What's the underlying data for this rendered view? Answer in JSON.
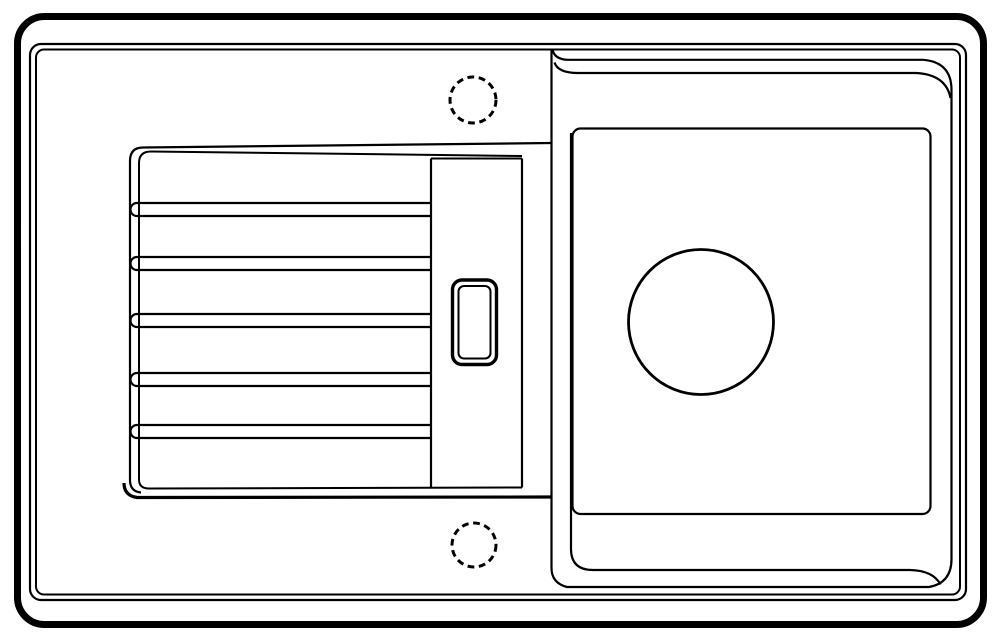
{
  "canvas": {
    "width": 1000,
    "height": 634,
    "background_color": "#ffffff",
    "line_color": "#000000"
  },
  "diagram": {
    "subject": "kitchen-sink-top-view-technical-line-drawing",
    "sections": {
      "left": "ribbed drainboard with pop-up control and two dashed faucet knockout holes",
      "right": "square bowl with round drain opening"
    },
    "default_stroke_width": 2.2,
    "shapes": [
      {
        "name": "sink-outer-edge",
        "kind": "rect",
        "x": 17.5,
        "y": 16.5,
        "width": 966,
        "height": 608,
        "rx": 27,
        "stroke_width": 7
      },
      {
        "name": "sink-rim-outer-line",
        "kind": "rect",
        "x": 30,
        "y": 44,
        "width": 936,
        "height": 556,
        "rx": 11,
        "stroke_width": 2.2
      },
      {
        "name": "sink-rim-inner-line",
        "kind": "rect",
        "x": 36,
        "y": 49.5,
        "width": 924,
        "height": 545,
        "rx": 8,
        "stroke_width": 2
      },
      {
        "name": "drainboard-outer-contour",
        "kind": "path",
        "d": "M 143 147.5 Q 130 147.5 130 161 L 130 480 Q 130 491.5 141 492.5",
        "stroke_width": 2.2
      },
      {
        "name": "drainboard-inner-contour",
        "kind": "path",
        "d": "M 151 151.5 Q 139 151.5 139 163 L 139 479.5 Q 139 488 148 488.5",
        "stroke_width": 2
      },
      {
        "name": "drainboard-top-edge",
        "kind": "path",
        "d": "M 143 147.5 L 551.5 143",
        "stroke_width": 2.2
      },
      {
        "name": "drainboard-top-inner-edge",
        "kind": "path",
        "d": "M 151 151.5 L 522 156",
        "stroke_width": 2
      },
      {
        "name": "drainboard-strip-top-edge",
        "kind": "path",
        "d": "M 431 158.5 L 522 158.5",
        "stroke_width": 2
      },
      {
        "name": "drainboard-bottom-inner-edge",
        "kind": "path",
        "d": "M 148 488.5 L 522 487.5",
        "stroke_width": 2
      },
      {
        "name": "drainboard-bottom-edge",
        "kind": "path",
        "d": "M 124 483 Q 124 495.5 137 497.5 L 551.5 497",
        "stroke_width": 3.2
      },
      {
        "name": "drainboard-groove-1",
        "kind": "path",
        "d": "M 431 203 L 137 203 A 6.5 6.5 0 0 0 137 216 L 431 216",
        "stroke_width": 2.2
      },
      {
        "name": "drainboard-groove-2",
        "kind": "path",
        "d": "M 431 257 L 137 257 A 6.5 6.5 0 0 0 137 270 L 431 270",
        "stroke_width": 2.2
      },
      {
        "name": "drainboard-groove-3",
        "kind": "path",
        "d": "M 431 314 L 137 314 A 6.5 6.5 0 0 0 137 327 L 431 327",
        "stroke_width": 2.2
      },
      {
        "name": "drainboard-groove-4",
        "kind": "path",
        "d": "M 431 373 L 137 373 A 6.5 6.5 0 0 0 137 386 L 431 386",
        "stroke_width": 2.2
      },
      {
        "name": "drainboard-groove-5",
        "kind": "path",
        "d": "M 431 425 L 137 425 A 6.5 6.5 0 0 0 137 438 L 431 438",
        "stroke_width": 2.2
      },
      {
        "name": "ribs-end-line",
        "kind": "path",
        "d": "M 431 158.5 L 431 487.5",
        "stroke_width": 2.2
      },
      {
        "name": "strip-right-line",
        "kind": "path",
        "d": "M 522 158.5 L 522 487.5",
        "stroke_width": 2.2
      },
      {
        "name": "popup-control-outer",
        "kind": "rect",
        "x": 452.5,
        "y": 280,
        "width": 44,
        "height": 84.5,
        "rx": 9.5,
        "stroke_width": 3.4
      },
      {
        "name": "popup-control-inner",
        "kind": "rect",
        "x": 458.5,
        "y": 286,
        "width": 32,
        "height": 72.5,
        "rx": 5.5,
        "stroke_width": 2
      },
      {
        "name": "faucet-hole-top",
        "kind": "circle",
        "cx": 473,
        "cy": 100,
        "r": 23,
        "stroke_width": 3,
        "dash": "6.8 4.6"
      },
      {
        "name": "faucet-hole-bottom",
        "kind": "circle",
        "cx": 474,
        "cy": 545,
        "r": 22,
        "stroke_width": 3,
        "dash": "6.8 4.6"
      },
      {
        "name": "bowl-rim-and-divider",
        "kind": "path",
        "d": "M 551.5 49.5 L 551.5 568 Q 551.5 583 567 587 L 929 587 Q 951.5 583 951.5 559 L 951.5 90 Q 951.5 62 923 59.8 L 568 59.8 Q 554.5 59.5 552.5 49.5",
        "stroke_width": 2.2
      },
      {
        "name": "bowl-wall-top-edge",
        "kind": "path",
        "d": "M 554.5 62.5 Q 558 73 578 73 L 916 73 Q 946 74.5 950.5 98",
        "stroke_width": 2.2
      },
      {
        "name": "bowl-wall-bottom-edge",
        "kind": "path",
        "d": "M 571 133 L 571 549 Q 571 570 593 570 L 910 570 Q 933 570.5 940.5 584.5",
        "stroke_width": 2.2
      },
      {
        "name": "bowl-floor-edge",
        "kind": "rect",
        "x": 572.5,
        "y": 128.5,
        "width": 358,
        "height": 385.5,
        "rx": 8,
        "stroke_width": 2.2
      },
      {
        "name": "drain-hole",
        "kind": "circle",
        "cx": 701,
        "cy": 322,
        "r": 72.5,
        "stroke_width": 2.8
      }
    ]
  }
}
